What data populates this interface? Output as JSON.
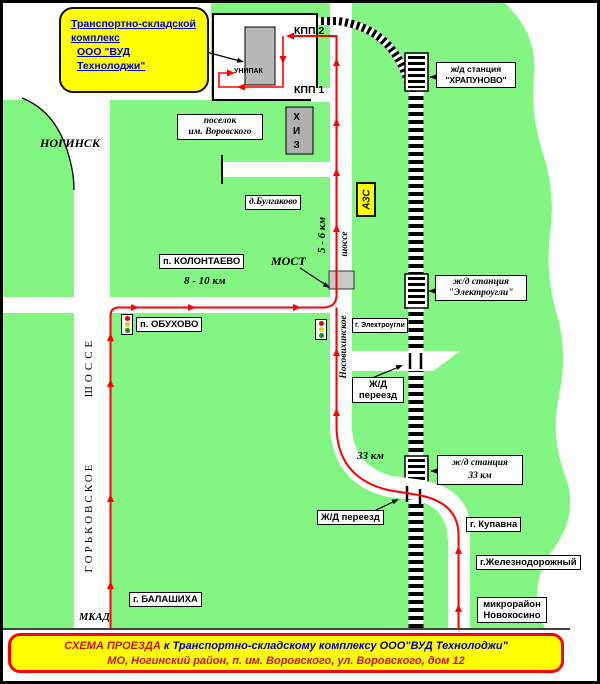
{
  "callout": {
    "line1": "Транспортно-складской",
    "line2": "комплекс",
    "line3": "ООО \"ВУД Технолоджи\""
  },
  "complex": {
    "kpp2": "КПП 2",
    "kpp1": "КПП 1",
    "unipak": "УНИПАК",
    "khiz_l1": "Х",
    "khiz_l2": "И",
    "khiz_l3": "З"
  },
  "stations": {
    "khrapunovo_l1": "ж/д станция",
    "khrapunovo_l2": "\"ХРАПУНОВО\"",
    "elektrougli_l1": "ж/д станция",
    "elektrougli_l2": "\"Электроугли\"",
    "km33_l1": "ж/д станция",
    "km33_l2": "33 км"
  },
  "places": {
    "noginsk": "НОГИНСК",
    "posyolok_l1": "поселок",
    "posyolok_l2": "им. Воровского",
    "bulgakovo": "д.Булгаково",
    "kolontaevo": "п. КОЛОНТАЕВО",
    "obukhovo": "п. ОБУХОВО",
    "elektrougli_town": "г. Электроугли",
    "kupavna": "г. Купавна",
    "zheleznodorozhny": "г.Железнодорожный",
    "novokosino_l1": "микрорайон",
    "novokosino_l2": "Новокосино",
    "balashikha": "г. БАЛАШИХА"
  },
  "roads": {
    "gorkovskoe_upper": "ШОССЕ",
    "gorkovskoe_lower": "ГОРЬКОВСКОЕ",
    "nosovikhinskoe_upper": "шоссе",
    "nosovikhinskoe_lower": "Носовихинское",
    "mkad": "МКАД"
  },
  "markers": {
    "azs": "АЗС",
    "most": "МОСТ",
    "dist_5_6": "5 - 6 км",
    "dist_8_10": "8 - 10 км",
    "km33": "33 км",
    "crossing_l1": "Ж/Д",
    "crossing_l2": "переезд",
    "crossing_single": "Ж/Д переезд"
  },
  "banner": {
    "title": "СХЕМА ПРОЕЗДА",
    "line1_rest": " к Транспортно-складскому комплексу ООО\"ВУД Технолоджи\"",
    "line2": "МО, Ногинский район, п. им. Воровского, ул. Воровского, дом 12"
  },
  "colors": {
    "map_green": "#82f582",
    "route_red": "#ff0000",
    "banner_yellow": "#ffff00",
    "banner_border_red": "#ff0000",
    "callout_text_blue": "#0000cc",
    "building_gray": "#b8b8b8",
    "traffic_red": "#e00000",
    "traffic_yellow": "#e8d000",
    "traffic_green": "#00a000"
  }
}
